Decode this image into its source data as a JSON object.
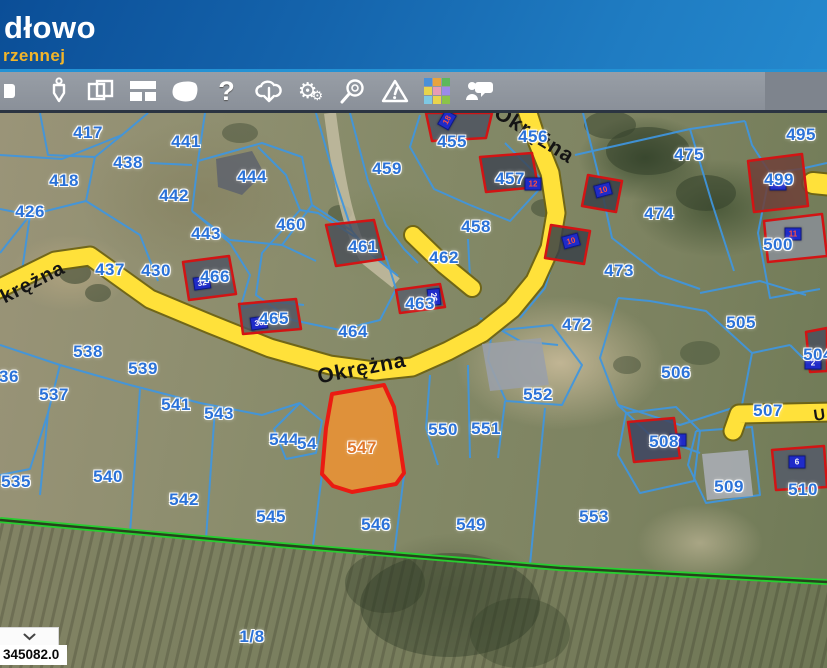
{
  "header": {
    "app_name_fragment": "dłowo",
    "tagline_fragment": "rzennej"
  },
  "toolbar": {
    "icons": [
      {
        "name": "tool-partial-icon"
      },
      {
        "name": "plumb-bob-icon"
      },
      {
        "name": "overlapping-windows-icon"
      },
      {
        "name": "layout-panels-icon"
      },
      {
        "name": "polygon-select-icon"
      },
      {
        "name": "help-icon",
        "glyph": "?"
      },
      {
        "name": "download-cloud-icon"
      },
      {
        "name": "settings-gears-icon"
      },
      {
        "name": "zoom-search-icon"
      },
      {
        "name": "warning-icon"
      },
      {
        "name": "legend-grid-icon"
      },
      {
        "name": "feedback-people-icon"
      }
    ],
    "legend_colors": [
      "#4a90d9",
      "#e8a33d",
      "#5cb85c",
      "#e8d44d",
      "#e89bb4",
      "#9b8ae8",
      "#7ec8e3",
      "#e8d44d",
      "#8bc34a"
    ]
  },
  "map": {
    "colors": {
      "parcel_boundary": "#3f96e0",
      "road_fill": "#ffe13a",
      "highlight_fill": "#f0912f",
      "highlight_border": "#ea1b12",
      "building_outline": "#d21414",
      "green_boundary": "#28cd30",
      "parcel_label": "#2b72d8"
    },
    "highlighted_parcel": {
      "number": "547"
    },
    "street_labels": [
      {
        "text": "krężna",
        "x": 33,
        "y": 170,
        "rot": -27,
        "size": 20
      },
      {
        "text": "Okrężna",
        "x": 362,
        "y": 256,
        "rot": -11,
        "size": 21
      },
      {
        "text": "Okrężna",
        "x": 534,
        "y": 22,
        "rot": 32,
        "size": 21
      },
      {
        "text": "U",
        "x": 820,
        "y": 303,
        "rot": -8,
        "size": 16
      }
    ],
    "parcel_labels": [
      {
        "number": "417",
        "x": 88,
        "y": 20
      },
      {
        "number": "441",
        "x": 186,
        "y": 29
      },
      {
        "number": "438",
        "x": 128,
        "y": 50
      },
      {
        "number": "418",
        "x": 64,
        "y": 68
      },
      {
        "number": "444",
        "x": 252,
        "y": 64
      },
      {
        "number": "442",
        "x": 174,
        "y": 83
      },
      {
        "number": "426",
        "x": 30,
        "y": 99
      },
      {
        "number": "443",
        "x": 206,
        "y": 121
      },
      {
        "number": "437",
        "x": 110,
        "y": 157
      },
      {
        "number": "430",
        "x": 156,
        "y": 158
      },
      {
        "number": "466",
        "x": 215,
        "y": 164
      },
      {
        "number": "465",
        "x": 274,
        "y": 206
      },
      {
        "number": "455",
        "x": 452,
        "y": 29
      },
      {
        "number": "456",
        "x": 533,
        "y": 24
      },
      {
        "number": "457",
        "x": 510,
        "y": 66
      },
      {
        "number": "459",
        "x": 387,
        "y": 56
      },
      {
        "number": "460",
        "x": 291,
        "y": 112
      },
      {
        "number": "458",
        "x": 476,
        "y": 114
      },
      {
        "number": "461",
        "x": 363,
        "y": 134
      },
      {
        "number": "462",
        "x": 444,
        "y": 145
      },
      {
        "number": "463",
        "x": 420,
        "y": 191
      },
      {
        "number": "464",
        "x": 353,
        "y": 219
      },
      {
        "number": "475",
        "x": 689,
        "y": 42
      },
      {
        "number": "495",
        "x": 801,
        "y": 22
      },
      {
        "number": "499",
        "x": 779,
        "y": 67
      },
      {
        "number": "474",
        "x": 659,
        "y": 101
      },
      {
        "number": "500",
        "x": 778,
        "y": 132
      },
      {
        "number": "473",
        "x": 619,
        "y": 158
      },
      {
        "number": "472",
        "x": 577,
        "y": 212
      },
      {
        "number": "505",
        "x": 741,
        "y": 210
      },
      {
        "number": "506",
        "x": 676,
        "y": 260
      },
      {
        "number": "504",
        "x": 818,
        "y": 242
      },
      {
        "number": "507",
        "x": 768,
        "y": 298
      },
      {
        "number": "508",
        "x": 664,
        "y": 329
      },
      {
        "number": "552",
        "x": 538,
        "y": 282
      },
      {
        "number": "551",
        "x": 486,
        "y": 316
      },
      {
        "number": "550",
        "x": 443,
        "y": 317
      },
      {
        "number": "547",
        "x": 362,
        "y": 335,
        "highlight": true
      },
      {
        "number": "544",
        "x": 284,
        "y": 327
      },
      {
        "number": "54",
        "x": 307,
        "y": 331
      },
      {
        "number": "541",
        "x": 176,
        "y": 292
      },
      {
        "number": "543",
        "x": 219,
        "y": 301
      },
      {
        "number": "539",
        "x": 143,
        "y": 256
      },
      {
        "number": "538",
        "x": 88,
        "y": 239
      },
      {
        "number": "537",
        "x": 54,
        "y": 282
      },
      {
        "number": "536",
        "x": 4,
        "y": 264
      },
      {
        "number": "535",
        "x": 16,
        "y": 369
      },
      {
        "number": "540",
        "x": 108,
        "y": 364
      },
      {
        "number": "542",
        "x": 184,
        "y": 387
      },
      {
        "number": "545",
        "x": 271,
        "y": 404
      },
      {
        "number": "546",
        "x": 376,
        "y": 412
      },
      {
        "number": "549",
        "x": 471,
        "y": 412
      },
      {
        "number": "553",
        "x": 594,
        "y": 404
      },
      {
        "number": "509",
        "x": 729,
        "y": 374
      },
      {
        "number": "510",
        "x": 803,
        "y": 377
      },
      {
        "number": "1/8",
        "x": 252,
        "y": 524
      }
    ],
    "building_plaques": [
      {
        "t": "18",
        "x": 447,
        "y": 7,
        "r": -60,
        "red": true
      },
      {
        "t": "12",
        "x": 533,
        "y": 71,
        "r": 0,
        "red": true
      },
      {
        "t": "32",
        "x": 202,
        "y": 170,
        "r": -8,
        "red": false
      },
      {
        "t": "30",
        "x": 259,
        "y": 210,
        "r": -8,
        "red": false
      },
      {
        "t": "26",
        "x": 434,
        "y": 184,
        "r": 84,
        "red": false
      },
      {
        "t": "10",
        "x": 603,
        "y": 77,
        "r": -15,
        "red": true
      },
      {
        "t": "10",
        "x": 571,
        "y": 128,
        "r": -15,
        "red": true
      },
      {
        "t": "4",
        "x": 778,
        "y": 71,
        "r": 0,
        "red": true
      },
      {
        "t": "11",
        "x": 793,
        "y": 121,
        "r": 0,
        "red": true
      },
      {
        "t": "7",
        "x": 678,
        "y": 327,
        "r": 0,
        "red": false
      },
      {
        "t": "6",
        "x": 797,
        "y": 349,
        "r": 0,
        "red": false
      },
      {
        "t": "2",
        "x": 813,
        "y": 250,
        "r": 0,
        "red": false
      }
    ]
  },
  "status_bar": {
    "coordinate_value": "345082.0"
  }
}
